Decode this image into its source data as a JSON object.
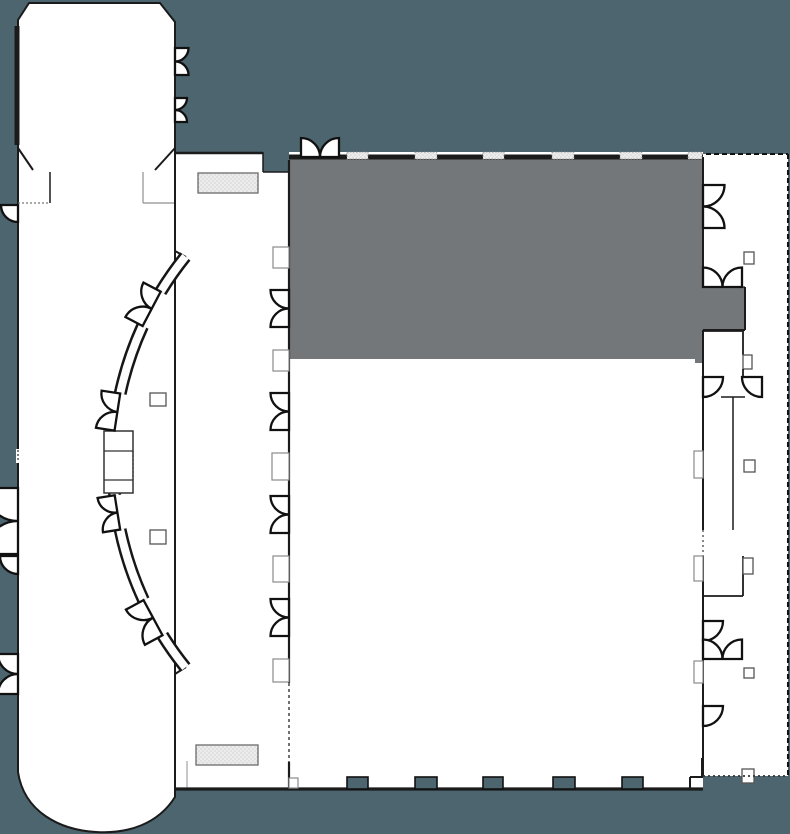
{
  "canvas": {
    "width": 790,
    "height": 834
  },
  "colors": {
    "background": "#4d656e",
    "floor": "#ffffff",
    "highlight": "#74777a",
    "wall": "#1b1b1b",
    "stipple_fill": "#ececec",
    "stipple_dot": "#b5b5b5",
    "dashed_boundary": "#111111"
  },
  "plan": {
    "type": "facility-floor-plan",
    "selected_region_name": "highlighted-hall-section",
    "regions": [
      {
        "name": "west-auditorium-wing",
        "fill": "floor"
      },
      {
        "name": "north-lobby-room",
        "fill": "floor"
      },
      {
        "name": "center-corridor",
        "fill": "floor"
      },
      {
        "name": "main-exhibit-hall",
        "fill": "floor"
      },
      {
        "name": "highlighted-hall-section",
        "fill": "highlight"
      },
      {
        "name": "east-service-corridor",
        "fill": "floor"
      }
    ],
    "features": {
      "curved_wall_segments": 5,
      "curved_wall_double_doors": 4,
      "corridor_double_doors": 4,
      "hall_top_wall_vents": 6,
      "hall_bottom_columns": 5,
      "stippled_mats": 2,
      "dashed_property_lines": 3
    }
  }
}
